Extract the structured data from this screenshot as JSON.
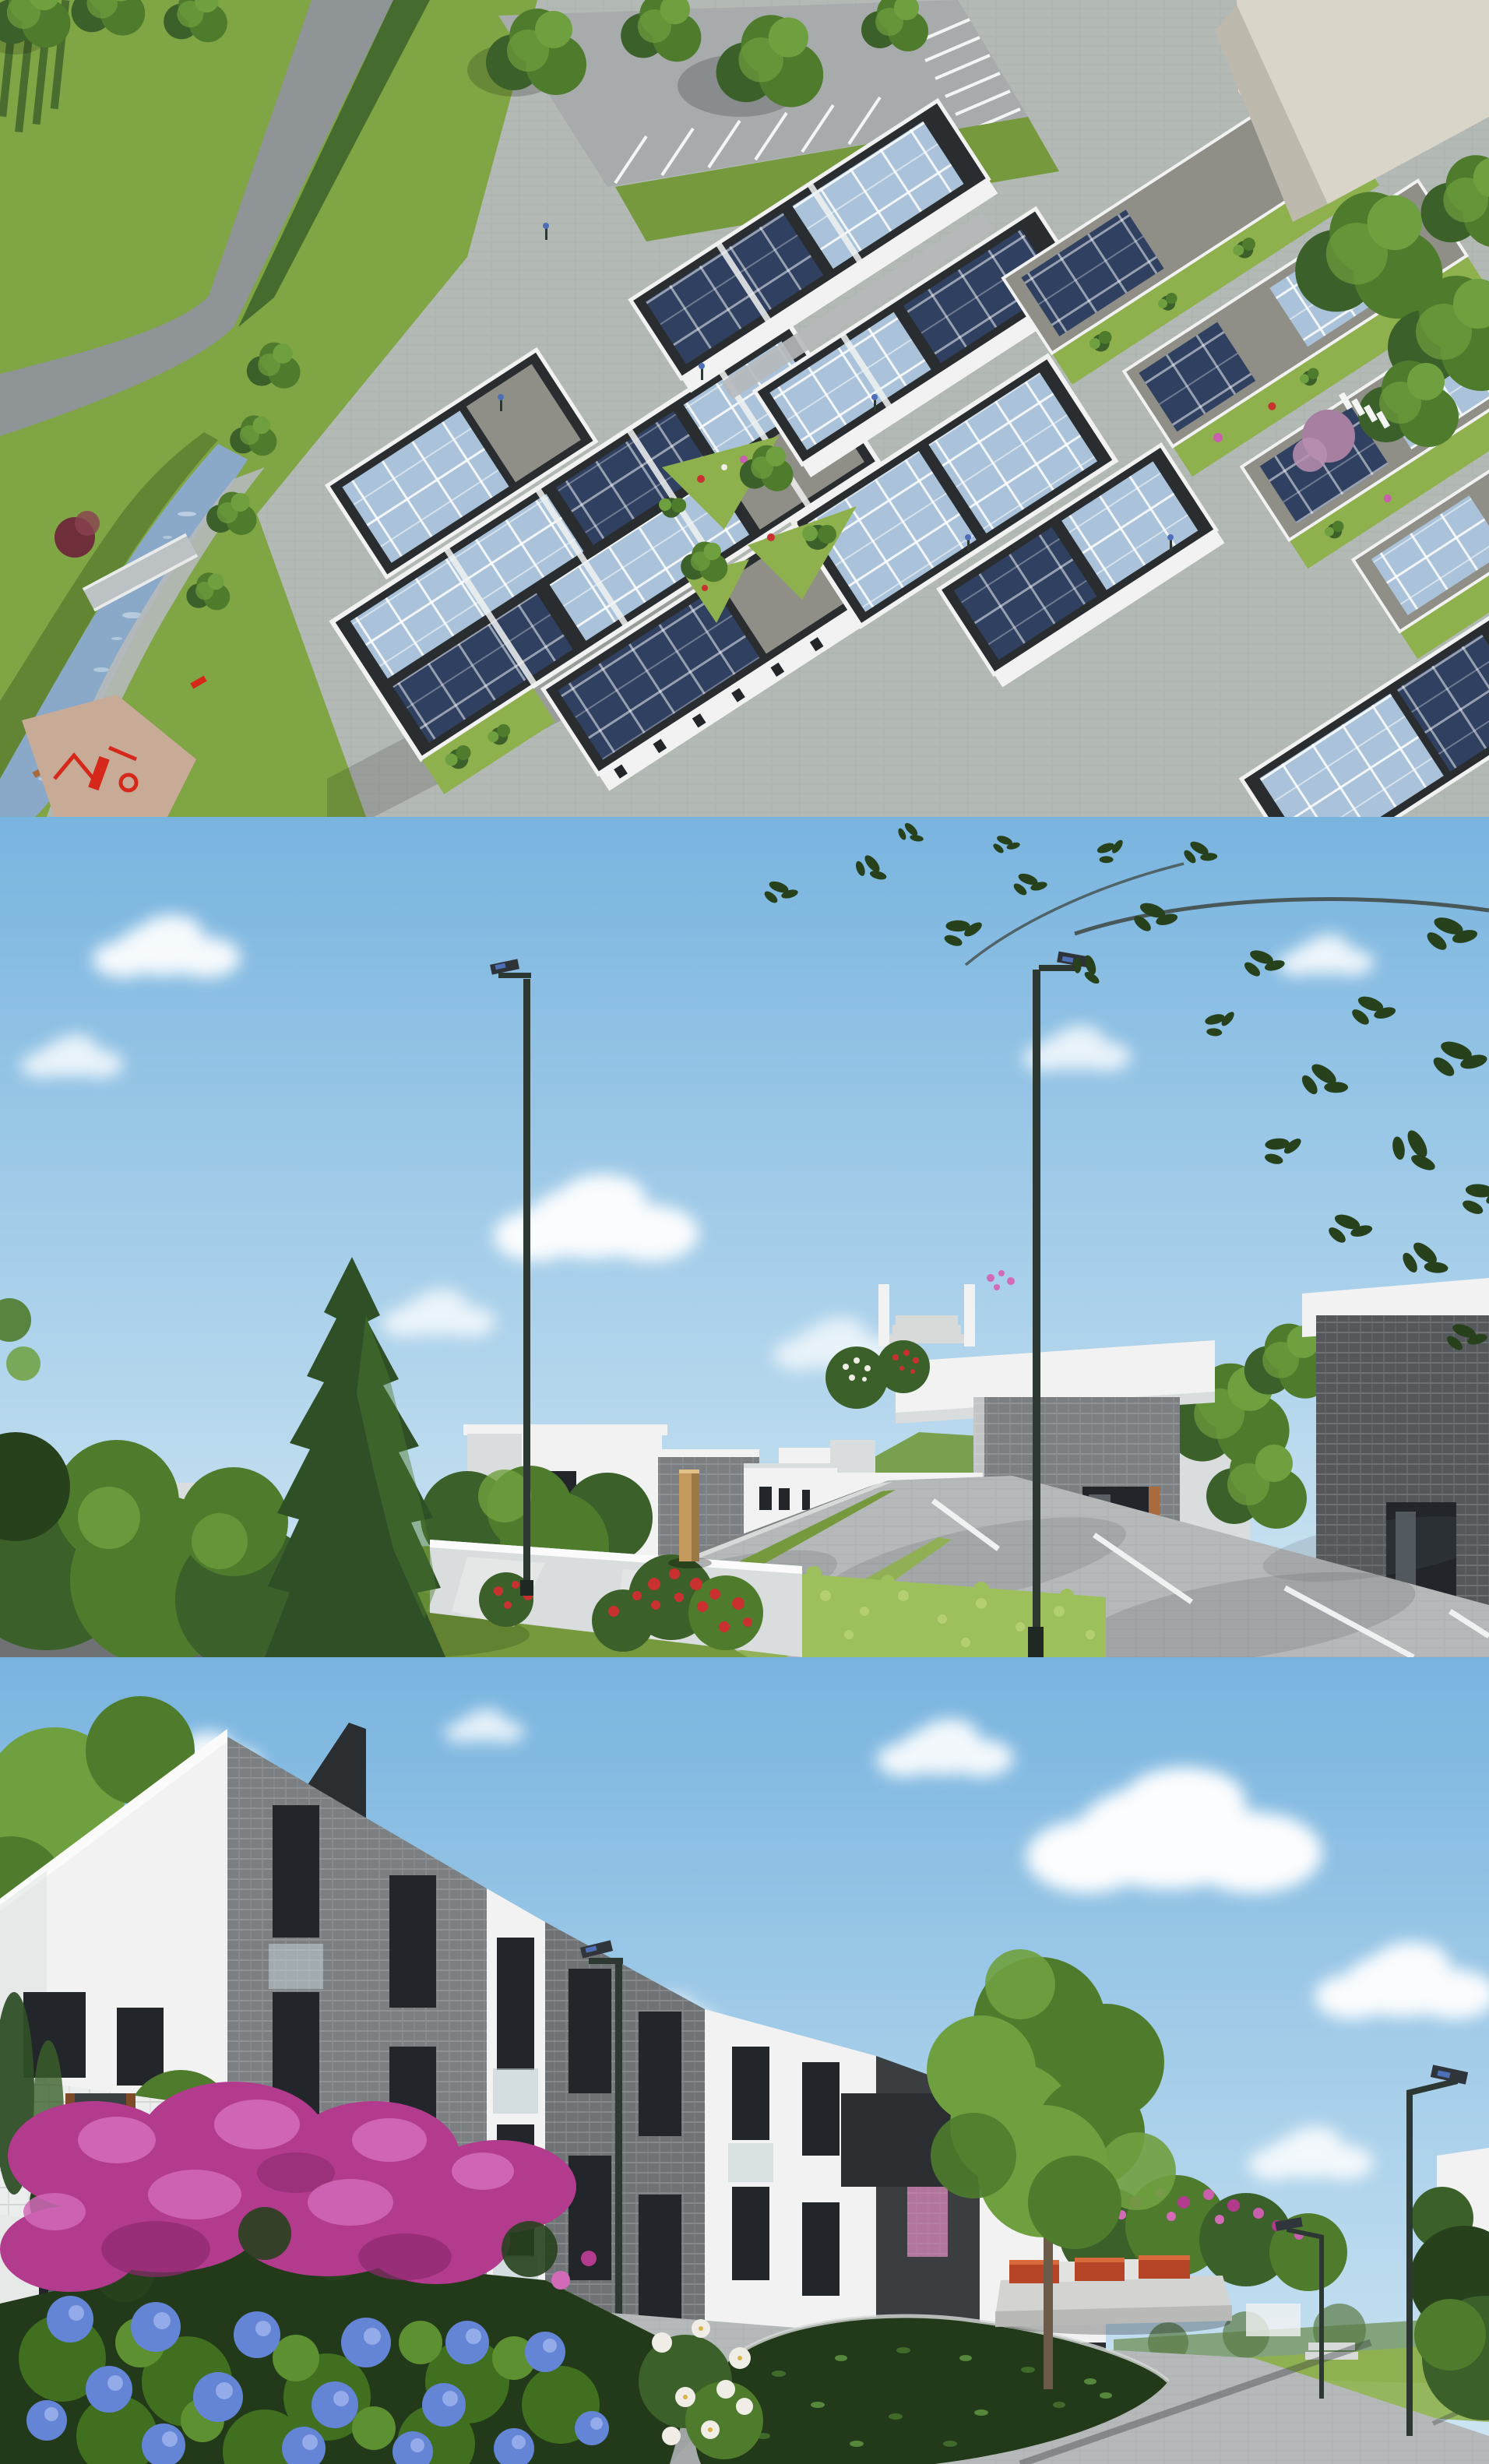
{
  "meta": {
    "title": "Residential estate architectural visualization collage",
    "media_type": "3D rendering collage",
    "panels_count": 3
  },
  "panels": [
    {
      "id": "aerial",
      "name": "Aerial masterplan view",
      "description": "Bird's-eye rendering of an eco housing estate: diagonal rows of townhouses with dark roofs covered in blue solar panels, landscaped courtyard with triangular planting beds, visitor parking at the top, a stream with a footbridge and red playground along the lower-left edge, green park field top-left and an existing beige building in the top-right corner."
    },
    {
      "id": "street",
      "name": "Street-level lane view",
      "description": "Eye-level rendering of the estate lane: white and grey-brick modern terraced houses receding to the left, a tall dark conifer and dense shrubs, red flowering bushes beside a concrete garden wall, a bright ivy hedge, a paved lane with white parking bay markings to the right, timber bollard, solar street lamps and overhanging leaves under a blue sky with clouds."
    },
    {
      "id": "courtyard",
      "name": "Courtyard walkway view",
      "description": "Eye-level rendering of the pedestrian courtyard: three-storey apartment houses in white render and grey brick with glass balconette railings and timber accents, foreground beds of magenta lilac and blue hydrangea with white flowers over dark ivy, an ivy island in the paver walkway, a concrete bench with red timber slats, pink shrubs, solar path lights and a distant green slope."
    }
  ],
  "palette": {
    "sky_top": "#79b4df",
    "sky_low": "#cfe6f3",
    "cloud": "#ffffff",
    "field": "#7fa544",
    "grass": "#75993c",
    "grass_dark": "#5c7f30",
    "grass_bright": "#8fb14d",
    "hill": "#79a04f",
    "asphalt": "#6f7274",
    "road": "#8f9496",
    "paver": "#b6b9ba",
    "paver_dark": "#a7abab",
    "curb": "#d8dada",
    "white_line": "#f4f6f6",
    "gravel": "#7e8081",
    "water": "#8aa9c8",
    "water_hl": "#dce8f1",
    "sand": "#c8ab97",
    "roof_dark": "#2a2d30",
    "gravel_roof": "#8f8e87",
    "panel_blue": "#2f4061",
    "panel_sky": "#aac3da",
    "wall_white": "#f1f2f1",
    "wall_shade": "#d9dddd",
    "wall_gray": "#bcc1c3",
    "brick": "#7b7f82",
    "brick_mid": "#6f7376",
    "brick_dark": "#55585b",
    "charcoal": "#2b2e31",
    "tower_dark": "#3b3e41",
    "window": "#22262a",
    "glass": "#96a9b6",
    "glass_light": "#c2cfd6",
    "wood": "#a96a3e",
    "wood_dark": "#7e4a28",
    "conifer": "#2f4f27",
    "tree": "#4e7c2c",
    "tree_light": "#6fa03f",
    "bush": "#3c602a",
    "leaf_dark": "#27411d",
    "hedge": "#9dc05c",
    "ivy": "#223a19",
    "ivy_leaf": "#3f6a2a",
    "red": "#c93030",
    "magenta": "#b23b8e",
    "magenta_light": "#d26ab8",
    "magenta_deep": "#8c2a6e",
    "blue_fl": "#6484d6",
    "blue_fl_light": "#93abe8",
    "white_fl": "#efede6",
    "pink": "#c95fae",
    "violet": "#a47fd0",
    "play_red": "#d6281a",
    "bench_red": "#b64527",
    "bollard": "#c49a5f",
    "pole": "#2c3831",
    "lamp_blue": "#4d6fb8",
    "beige": "#d9d5c9",
    "beige_shade": "#bdb9ad"
  }
}
